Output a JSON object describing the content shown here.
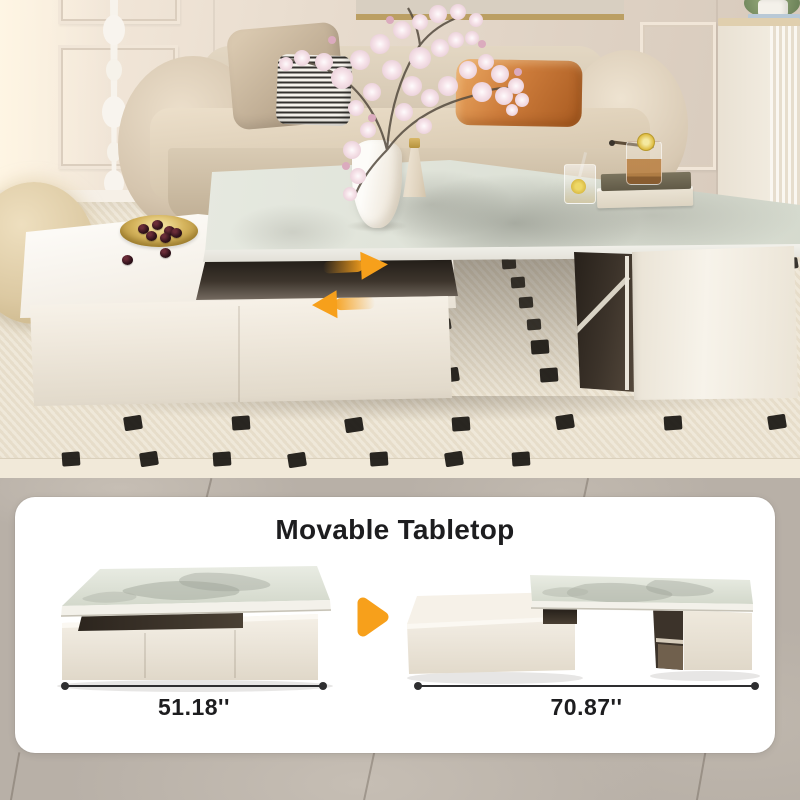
{
  "panel": {
    "title": "Movable Tabletop",
    "diagrams": [
      {
        "id": "compact",
        "dimension_label": "51.18''"
      },
      {
        "id": "extended",
        "dimension_label": "70.87''"
      }
    ]
  },
  "photo": {
    "annotations": {
      "slide_right_arrow_icon": "slide-right-arrow",
      "slide_left_arrow_icon": "slide-left-arrow",
      "transform_arrow_icon": "transform-arrow"
    }
  },
  "colors": {
    "accent_orange": "#F7A01B",
    "ink": "#1D1D1F",
    "panel_background": "#FFFFFF"
  }
}
